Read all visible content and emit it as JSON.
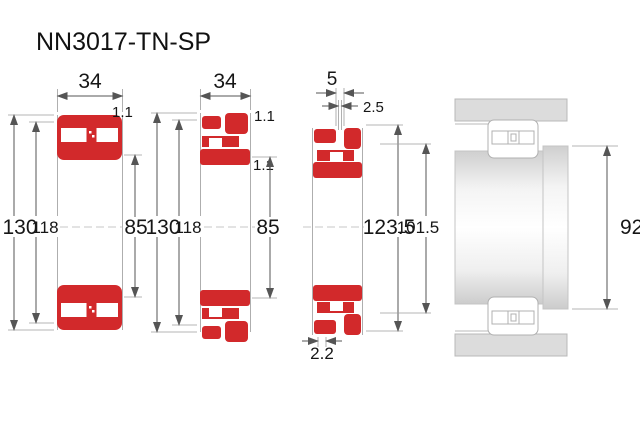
{
  "title": "NN3017-TN-SP",
  "colors": {
    "bearing_red": "#d2292b",
    "housing_gray": "#dcdcdc",
    "dim_line": "#555555"
  },
  "views": {
    "section_basic": {
      "width": "34",
      "chamfer": "1.1",
      "outer_diameter": "130",
      "outer_raceway_diameter": "118",
      "bore_diameter": "85"
    },
    "section_cage": {
      "width": "34",
      "outer_chamfer": "1.1",
      "inner_chamfer": "1.1",
      "outer_diameter": "130",
      "outer_raceway_diameter": "118",
      "bore_diameter": "85"
    },
    "section_groove": {
      "groove_width": "5",
      "hole_diameter": "2.5",
      "groove_diameter": "123.5",
      "shoulder_diameter": "101.5",
      "groove_offset": "2.2"
    },
    "mounting": {
      "abutment_diameter": "92"
    }
  }
}
